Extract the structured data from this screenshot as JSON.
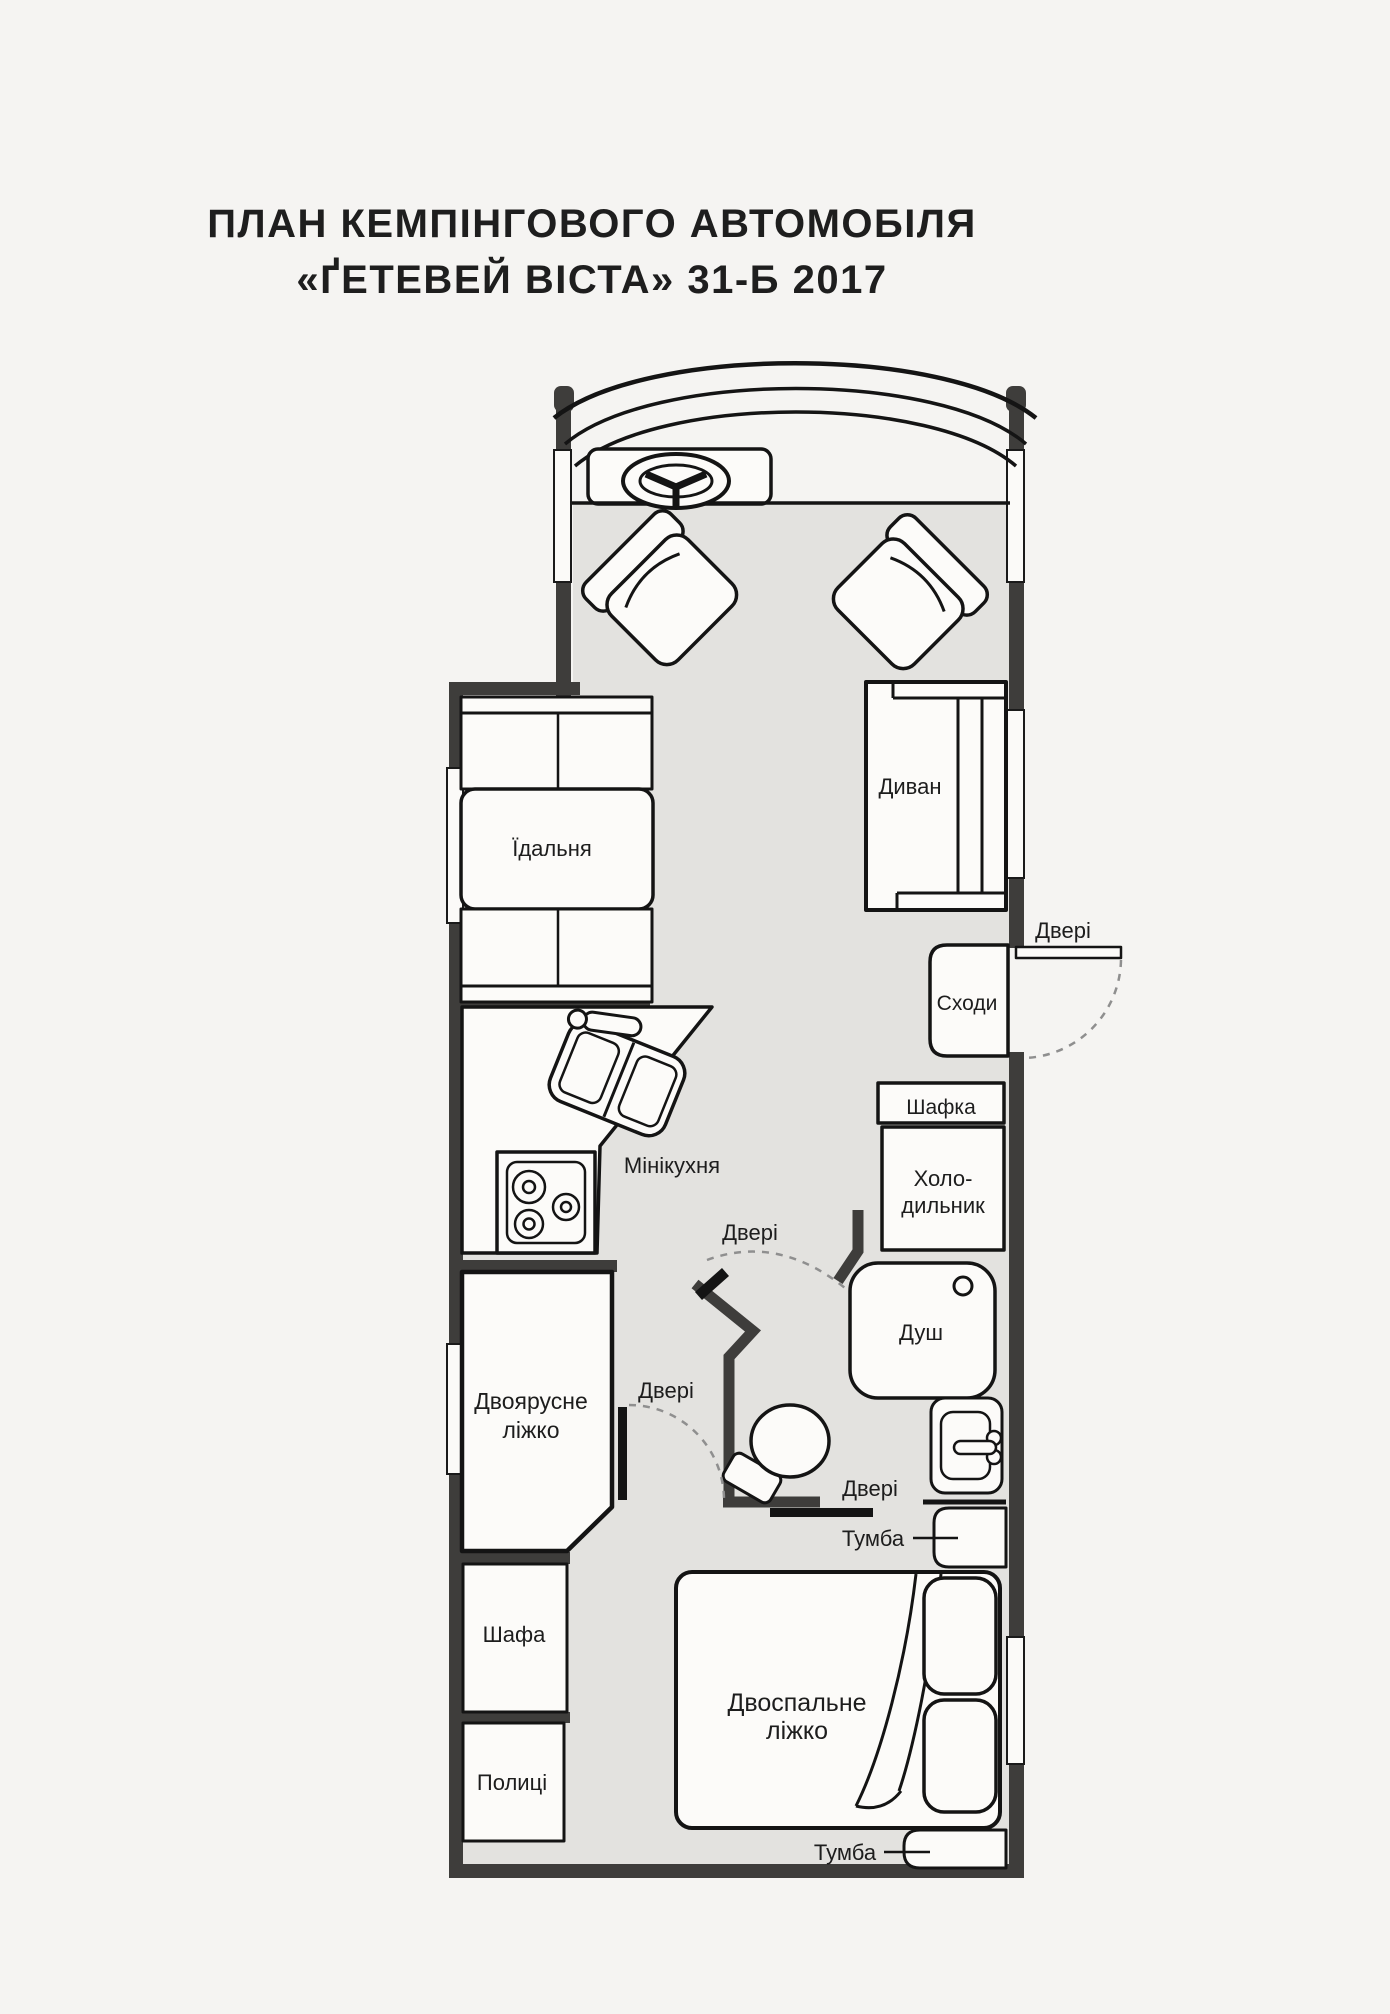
{
  "title": {
    "line1": "ПЛАН КЕМПІНГОВОГО АВТОМОБІЛЯ",
    "line2": "«ҐЕТЕВЕЙ ВІСТА» 31-Б 2017"
  },
  "labels": {
    "dining": "Їдальня",
    "sofa": "Диван",
    "door": "Двері",
    "stairs": "Сходи",
    "cabinet": "Шафка",
    "fridge_line1": "Холо-",
    "fridge_line2": "дильник",
    "mini_kitchen": "Мінікухня",
    "shower": "Душ",
    "bunk_bed_line1": "Двоярусне",
    "bunk_bed_line2": "ліжко",
    "wardrobe": "Шафа",
    "shelves": "Полиці",
    "nightstand": "Тумба",
    "double_bed_line1": "Двоспальне",
    "double_bed_line2": "ліжко"
  },
  "colors": {
    "paper": "#f5f4f2",
    "floor": "#e3e2df",
    "wall": "#3e3d3b",
    "line": "#141414",
    "dash_gray": "#8f8f8f",
    "text": "#1d1d1d"
  }
}
